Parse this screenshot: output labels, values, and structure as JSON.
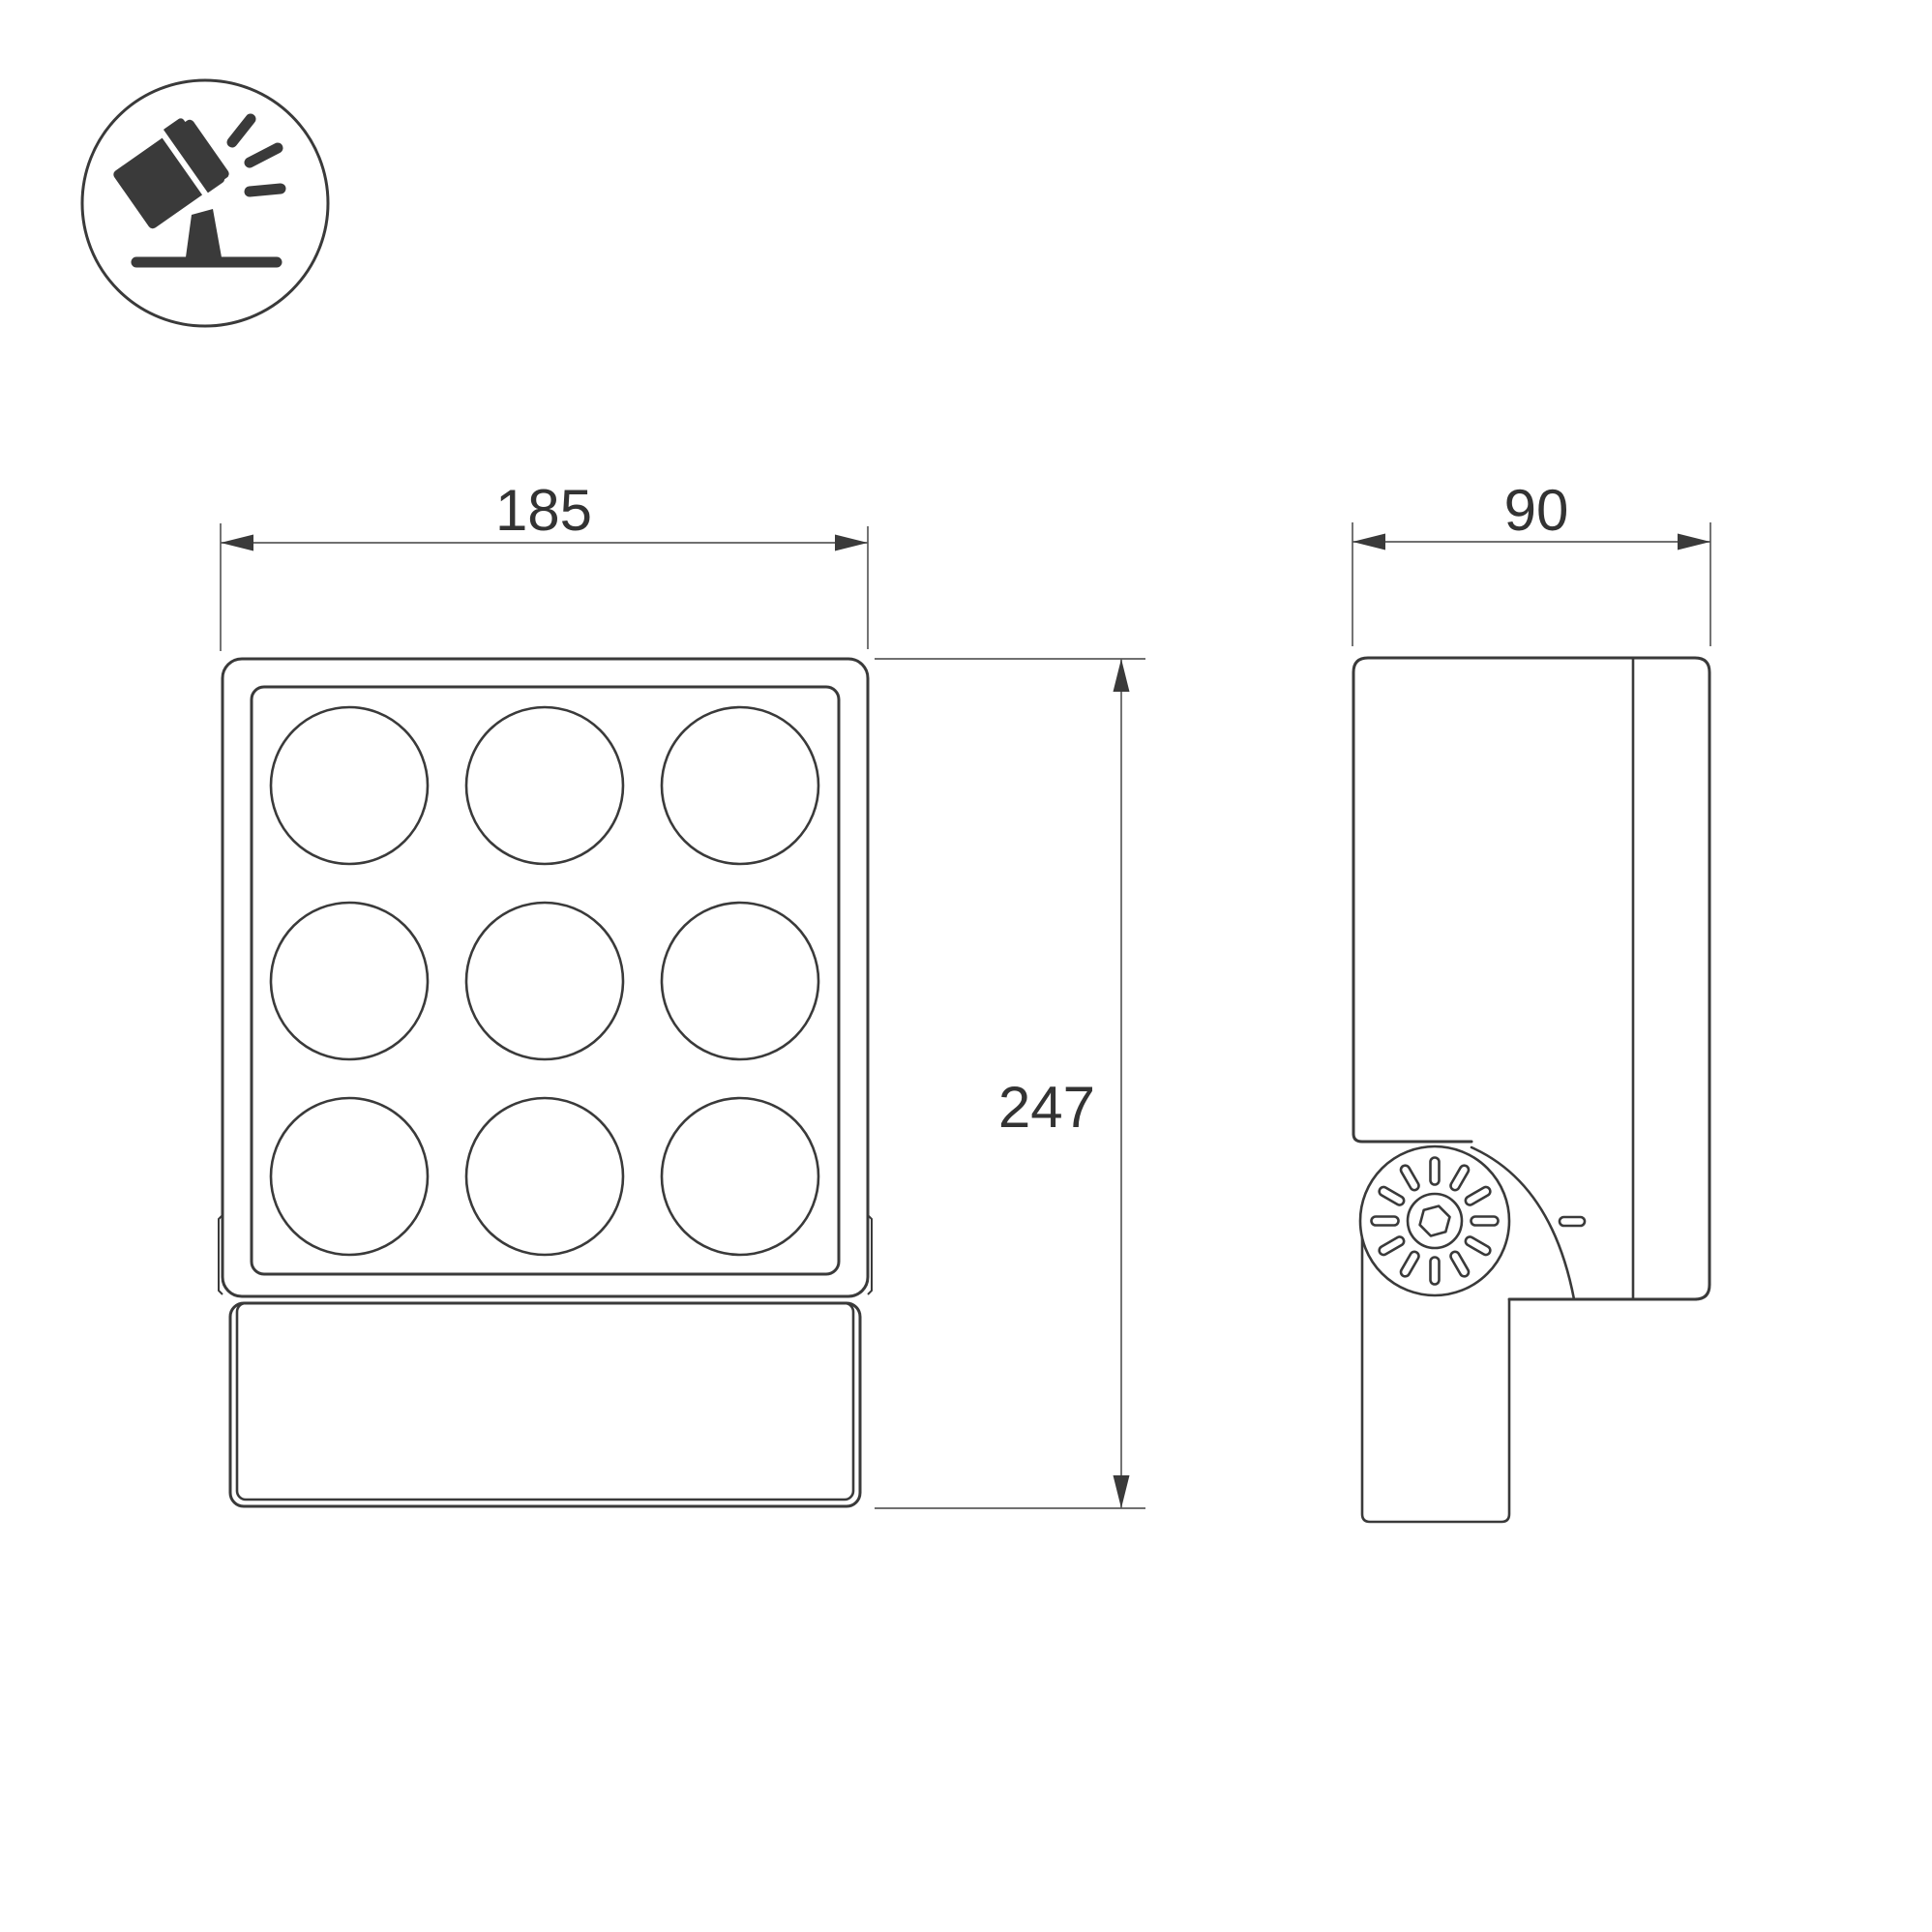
{
  "colors": {
    "bg": "#ffffff",
    "line": "#3a3a3a",
    "thin": "#5c5c5c",
    "text": "#333333"
  },
  "icon": {
    "name": "tilted-floodlight"
  },
  "dimensions": {
    "front_width": "185",
    "front_height": "247",
    "side_depth": "90"
  }
}
